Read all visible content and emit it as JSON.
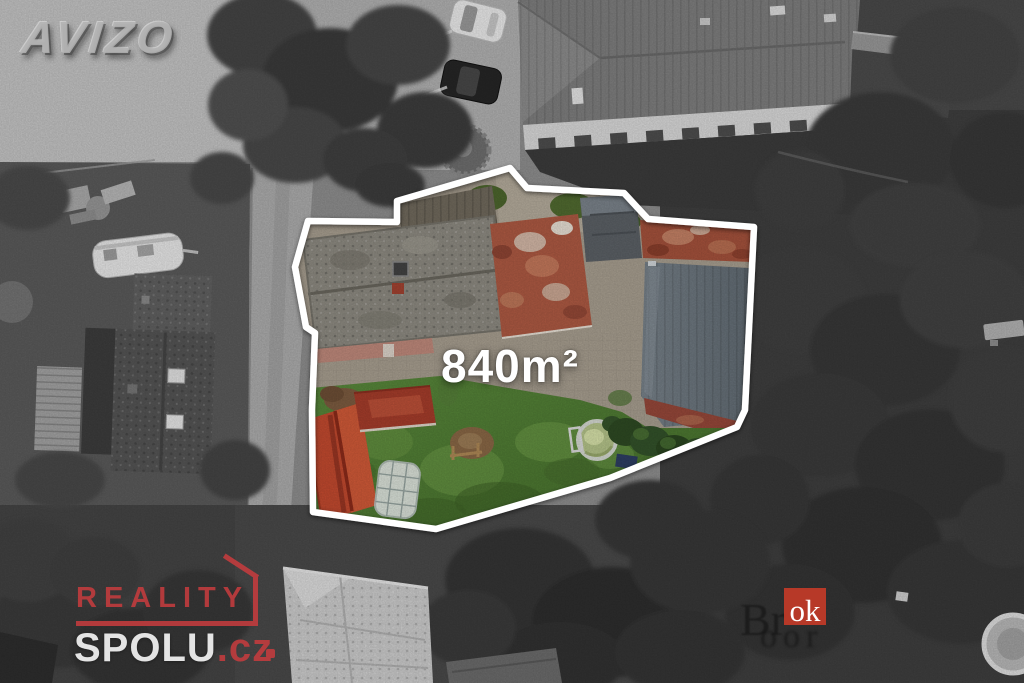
{
  "plot": {
    "area_label": "840m²",
    "outline_color": "#ffffff"
  },
  "watermarks": {
    "avizo": {
      "text": "AVIZO"
    },
    "reality_spolu": {
      "line1": "REALITY",
      "line2": "SPOLU",
      "tld": ".cz"
    },
    "brok": {
      "prefix": "Br",
      "badge": "ok",
      "subtext": "oor"
    }
  },
  "palette": {
    "plot_outline": "#ffffff",
    "logo_red": "#c63c3e",
    "badge_red": "#c33b28",
    "lawn_green": "#4e7c33",
    "barn_roof_red": "#c34a2f",
    "brick_roof_red": "#ae5a43",
    "slate_roof_gray": "#6d767d",
    "pavement_gray": "#b2b2b2"
  }
}
